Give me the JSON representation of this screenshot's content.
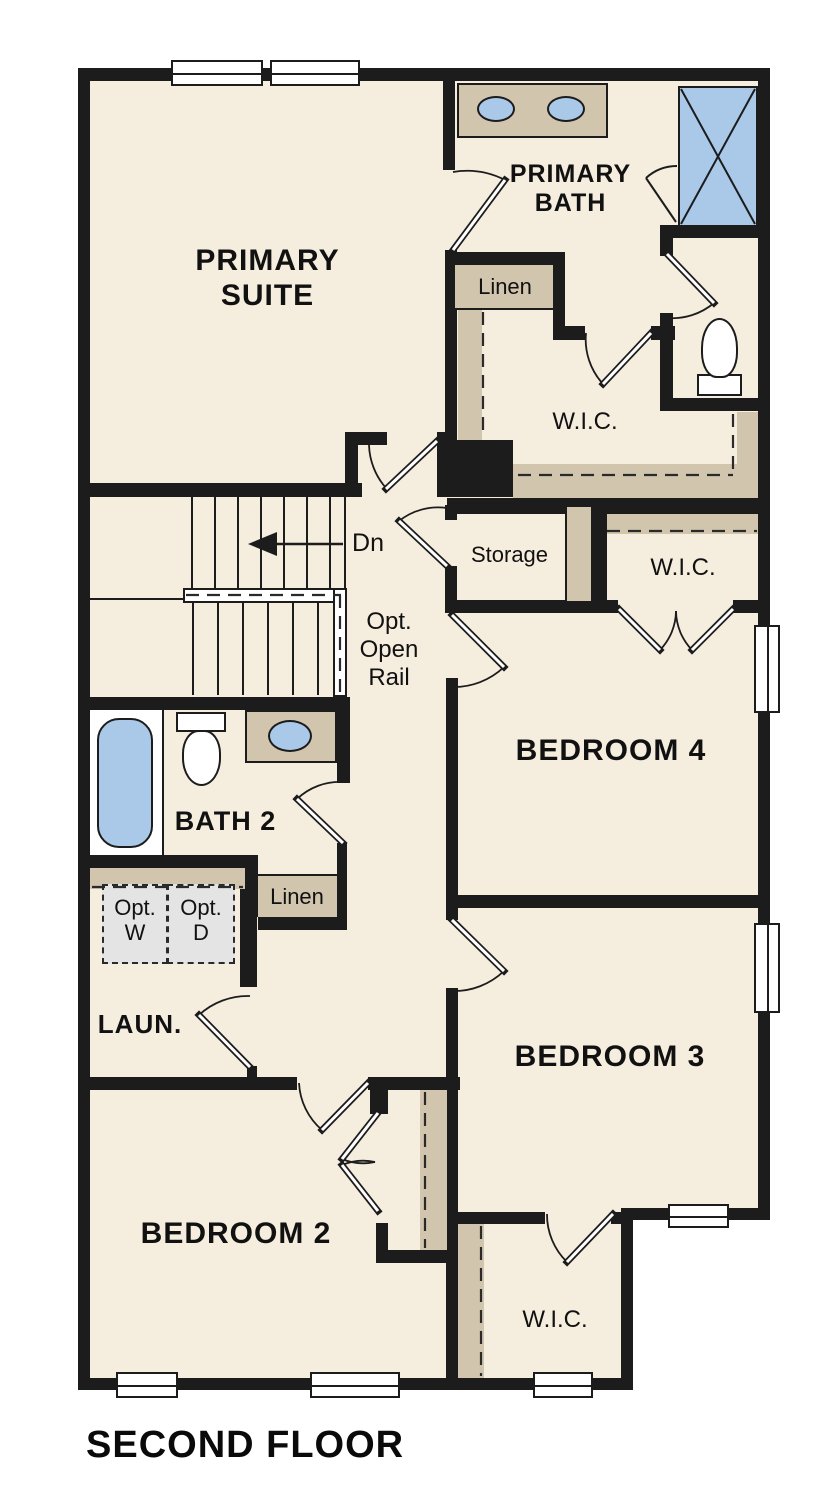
{
  "palette": {
    "wall": "#1c1c1c",
    "floor": "#f5edde",
    "cabinet_tan": "#d2c5ae",
    "fixture_blue": "#aac9e9",
    "appliance_gray": "#e4e4e4",
    "background": "#ffffff"
  },
  "title": "SECOND FLOOR",
  "rooms": {
    "primary_suite": {
      "lines": [
        "PRIMARY",
        "SUITE"
      ]
    },
    "primary_bath": {
      "lines": [
        "PRIMARY",
        "BATH"
      ]
    },
    "bedroom4": {
      "label": "BEDROOM 4"
    },
    "bedroom3": {
      "label": "BEDROOM 3"
    },
    "bedroom2": {
      "label": "BEDROOM 2"
    },
    "bath2": {
      "label": "BATH 2"
    },
    "laundry": {
      "label": "LAUN."
    },
    "storage": {
      "label": "Storage"
    },
    "wic_primary": {
      "label": "W.I.C."
    },
    "wic_bedroom4": {
      "label": "W.I.C."
    },
    "wic_bedroom3": {
      "label": "W.I.C."
    },
    "linen_primary": {
      "label": "Linen"
    },
    "linen_hall": {
      "label": "Linen"
    }
  },
  "stairs": {
    "direction_label": "Dn",
    "open_rail_lines": [
      "Opt.",
      "Open",
      "Rail"
    ]
  },
  "laundry_appliances": {
    "washer_lines": [
      "Opt.",
      "W"
    ],
    "dryer_lines": [
      "Opt.",
      "D"
    ]
  }
}
